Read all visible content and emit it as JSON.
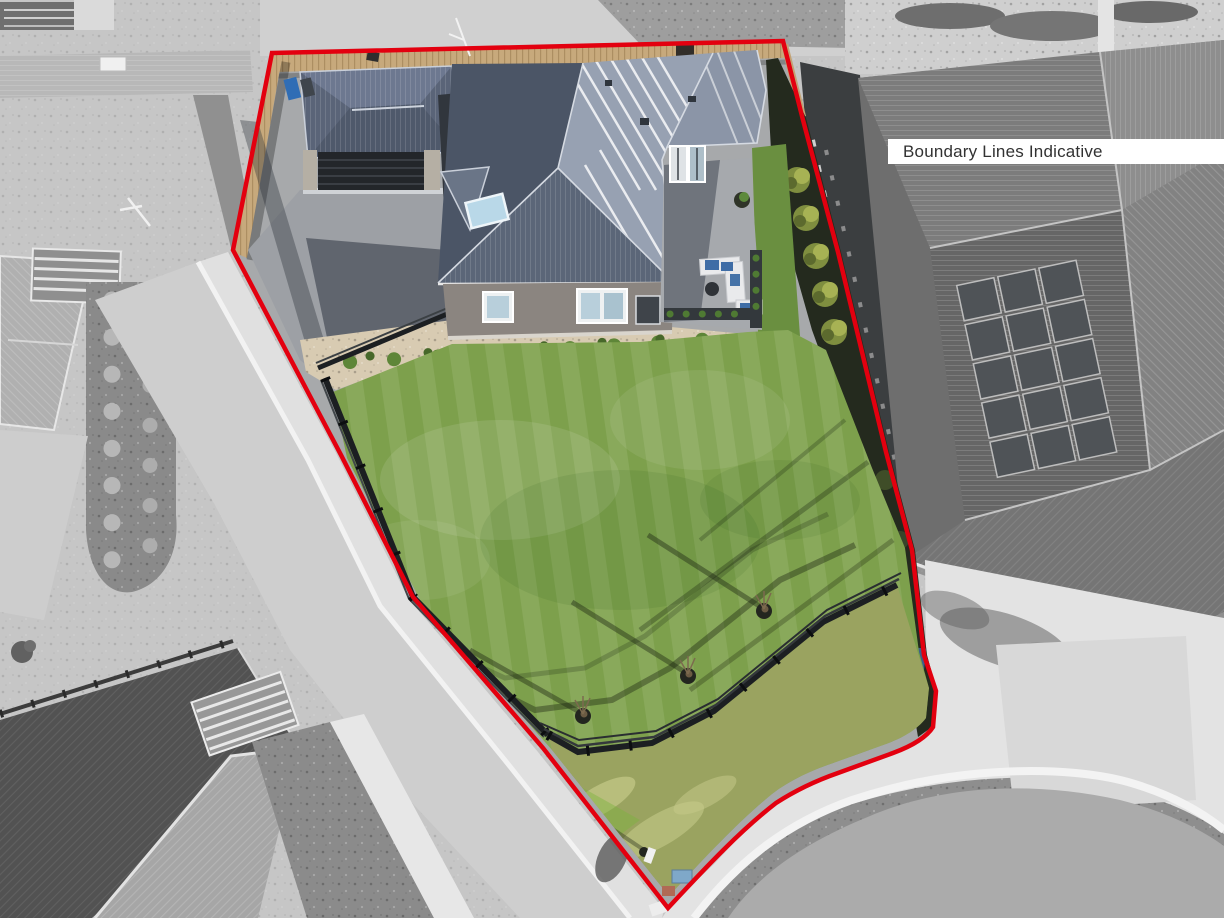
{
  "overlay": {
    "boundary_label": "Boundary Lines Indicative"
  },
  "colors": {
    "boundary_red": "#e3000f",
    "label_background": "#ffffff",
    "label_text": "#323232",
    "lawn_green": "#7da04c",
    "lawn_lower_green": "#9aa360",
    "roof_dark_face": "#4b5566",
    "roof_light_face": "#97a1b2",
    "timber_fence_tan": "#c7a97c",
    "driveway_gray": "#9da0a5",
    "gravel_bed_tan": "#d8cbb2",
    "hedge_dark": "#242a1e",
    "neighbor_roof_gray": "#6e6e6e",
    "solar_panel_gray": "#4f5357",
    "road_gray": "#cecece",
    "curb_white": "#f3f3f3",
    "cul_de_sac_gray": "#ababab",
    "black_fence": "#1c1f22",
    "skylight_blue": "#b9d8e8"
  }
}
